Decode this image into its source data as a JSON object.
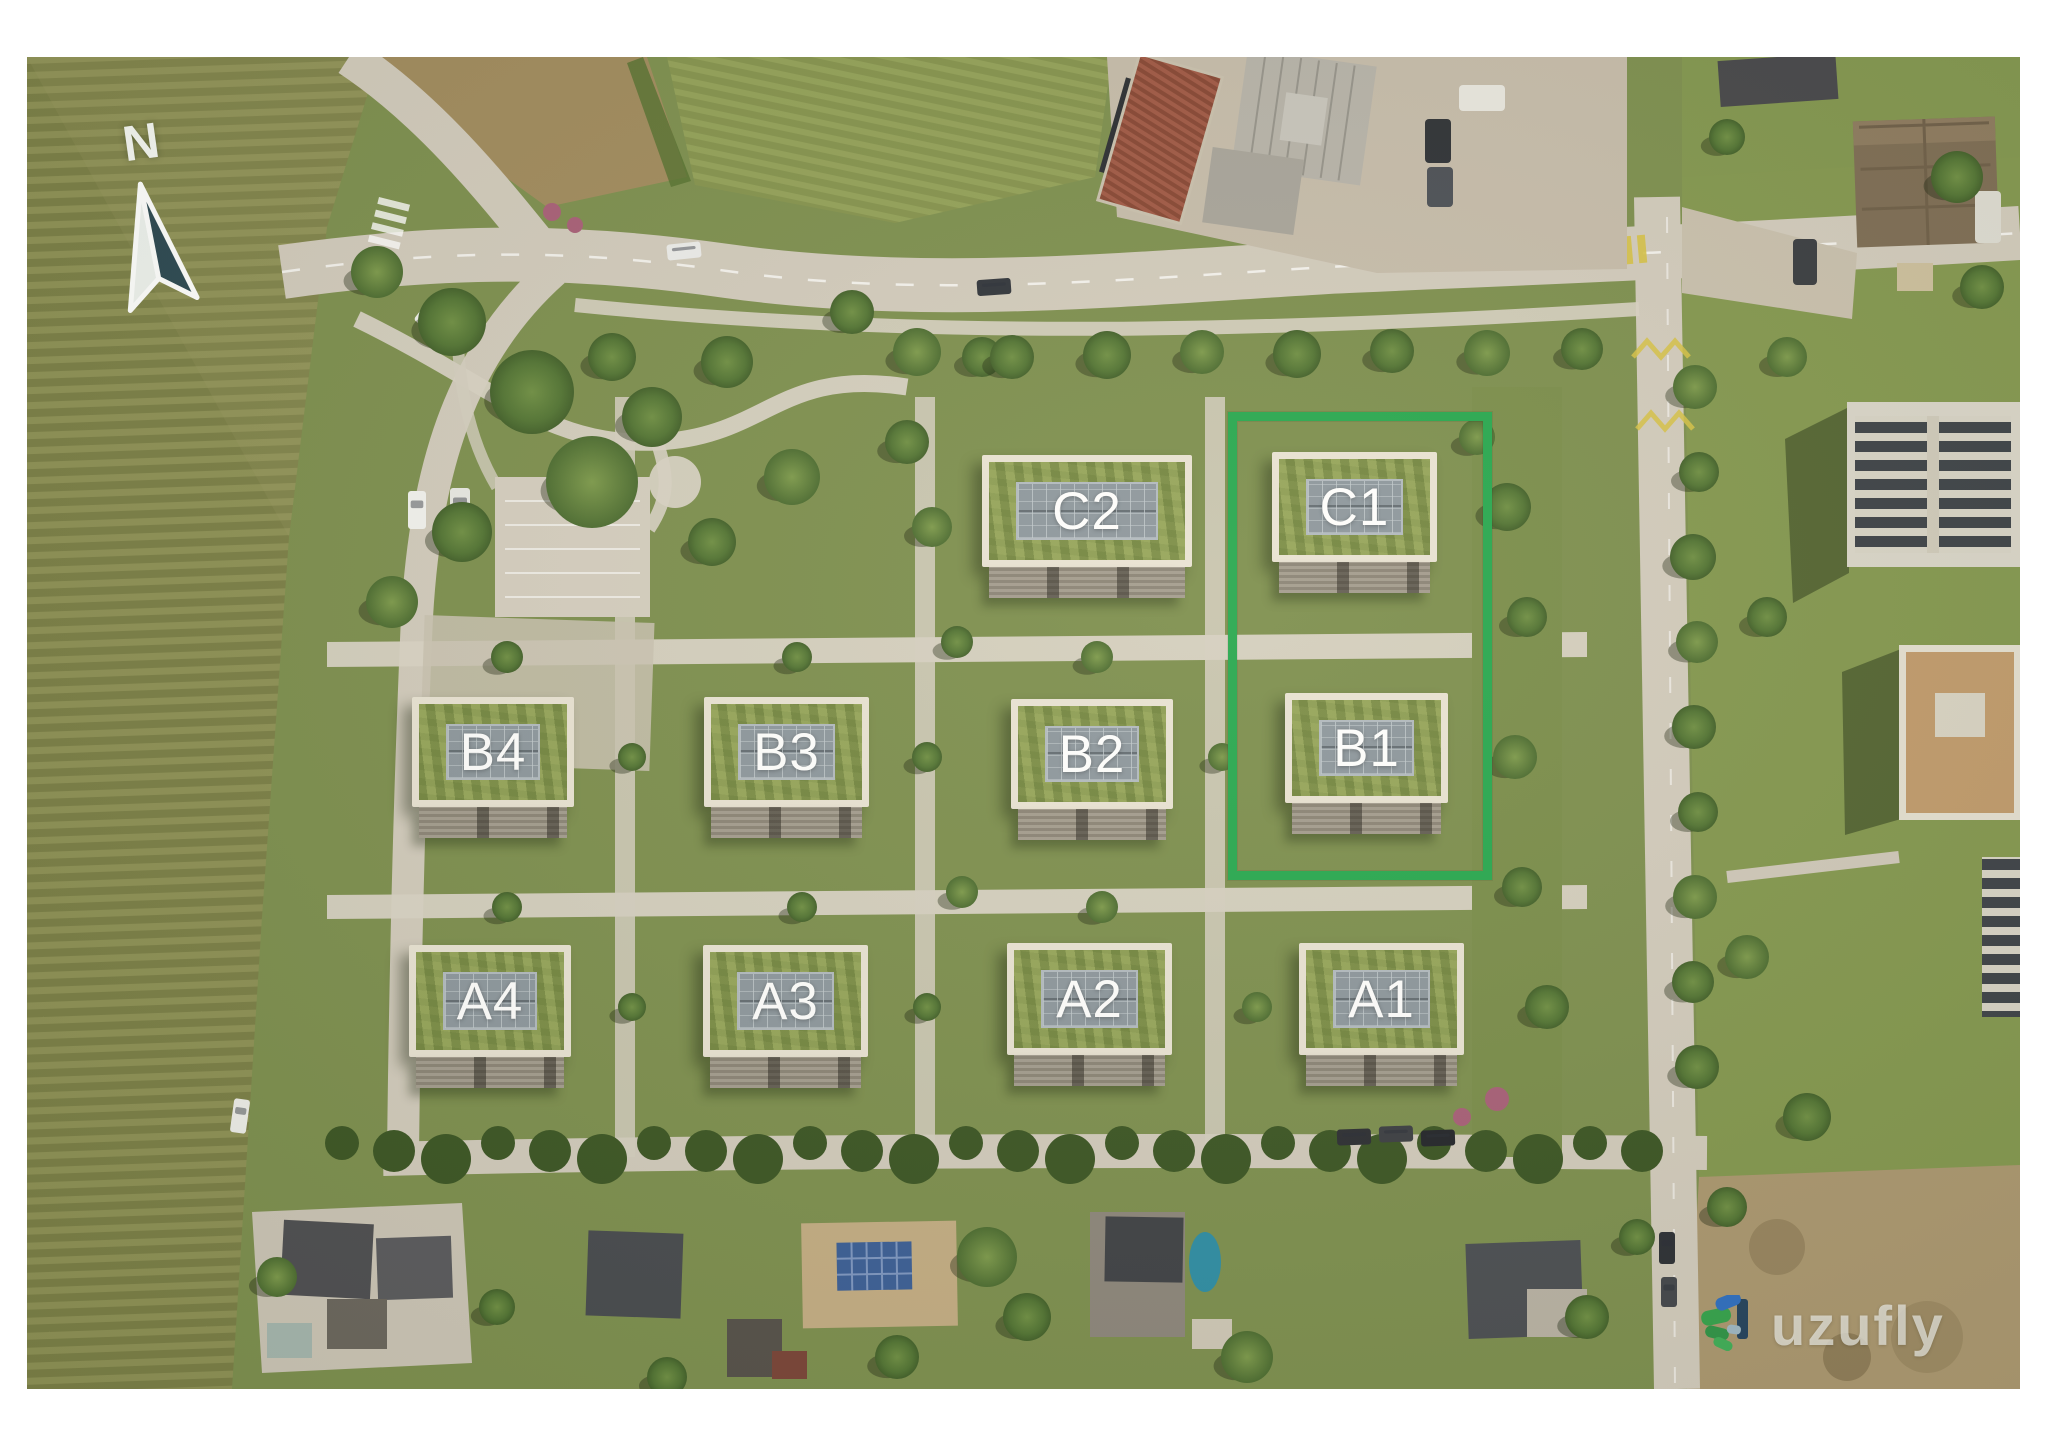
{
  "plan": {
    "compass": {
      "label": "N"
    },
    "watermark": {
      "text": "uzufly"
    },
    "highlight": {
      "color": "#27a850",
      "x": 1201,
      "y": 355,
      "w": 264,
      "h": 468,
      "contains": [
        "C1",
        "B1"
      ]
    },
    "buildings": [
      {
        "id": "C2",
        "label": "C2",
        "highlighted": false,
        "x": 955,
        "y": 398,
        "w": 210,
        "h": 112
      },
      {
        "id": "C1",
        "label": "C1",
        "highlighted": true,
        "x": 1245,
        "y": 395,
        "w": 165,
        "h": 110
      },
      {
        "id": "B4",
        "label": "B4",
        "highlighted": false,
        "x": 385,
        "y": 640,
        "w": 162,
        "h": 110
      },
      {
        "id": "B3",
        "label": "B3",
        "highlighted": false,
        "x": 677,
        "y": 640,
        "w": 165,
        "h": 110
      },
      {
        "id": "B2",
        "label": "B2",
        "highlighted": false,
        "x": 984,
        "y": 642,
        "w": 162,
        "h": 110
      },
      {
        "id": "B1",
        "label": "B1",
        "highlighted": true,
        "x": 1258,
        "y": 636,
        "w": 163,
        "h": 110
      },
      {
        "id": "A4",
        "label": "A4",
        "highlighted": false,
        "x": 382,
        "y": 888,
        "w": 162,
        "h": 112
      },
      {
        "id": "A3",
        "label": "A3",
        "highlighted": false,
        "x": 676,
        "y": 888,
        "w": 165,
        "h": 112
      },
      {
        "id": "A2",
        "label": "A2",
        "highlighted": false,
        "x": 980,
        "y": 886,
        "w": 165,
        "h": 112
      },
      {
        "id": "A1",
        "label": "A1",
        "highlighted": false,
        "x": 1272,
        "y": 886,
        "w": 165,
        "h": 112
      }
    ],
    "colors": {
      "highlight_green": "#27a850",
      "label_text": "#ffffff",
      "roof_panel": "#8d979e",
      "roof_ring": "#8a9a55",
      "road": "#d2cbbd"
    }
  }
}
